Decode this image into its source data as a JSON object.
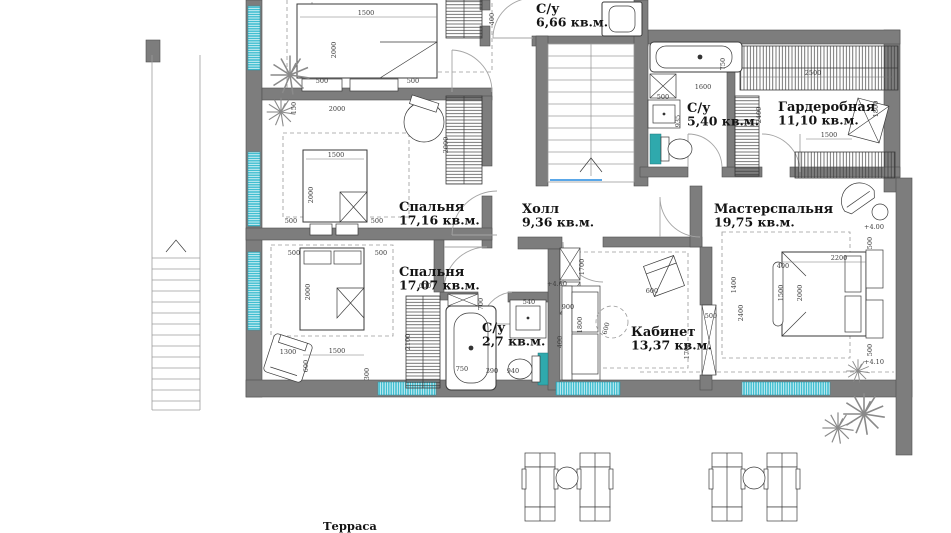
{
  "plan_title": "Floor plan (level +4.00)",
  "colors": {
    "wall": "#7d7d7d",
    "window": "#38bccf",
    "teal_accent": "#2fa9ad",
    "stair_blue": "#5aa7e8",
    "text": "#141414",
    "dimension_text": "#3d3d3d",
    "background": "#ffffff"
  },
  "rooms": [
    {
      "name": "С/у",
      "area": "6,66 кв.м.",
      "x": 536,
      "y": 5
    },
    {
      "name": "Спальня",
      "area": "17,16 кв.м.",
      "x": 399,
      "y": 203
    },
    {
      "name": "Холл",
      "area": "9,36 кв.м.",
      "x": 522,
      "y": 205
    },
    {
      "name": "Мастерспальня",
      "area": "19,75 кв.м.",
      "x": 714,
      "y": 205
    },
    {
      "name": "С/у",
      "area": "5,40 кв.м.",
      "x": 687,
      "y": 104
    },
    {
      "name": "Гардеробная",
      "area": "11,10 кв.м.",
      "x": 778,
      "y": 103
    },
    {
      "name": "Спальня",
      "area": "17,07 кв.м.",
      "x": 399,
      "y": 268
    },
    {
      "name": "С/у",
      "area": "2,7 кв.м.",
      "x": 482,
      "y": 324
    },
    {
      "name": "Кабинет",
      "area": "13,37 кв.м.",
      "x": 631,
      "y": 328
    }
  ],
  "terrace": {
    "label": "Терраса",
    "x": 345,
    "y": 530
  },
  "dimensions": [
    {
      "t": "1500",
      "x": 366,
      "y": 15
    },
    {
      "t": "2000",
      "x": 336,
      "y": 50,
      "r": -90
    },
    {
      "t": "500",
      "x": 322,
      "y": 83
    },
    {
      "t": "500",
      "x": 413,
      "y": 83
    },
    {
      "t": "2000",
      "x": 337,
      "y": 111
    },
    {
      "t": "150",
      "x": 296,
      "y": 108,
      "r": -90
    },
    {
      "t": "1500",
      "x": 336,
      "y": 157
    },
    {
      "t": "2000",
      "x": 313,
      "y": 195,
      "r": -90
    },
    {
      "t": "2000",
      "x": 448,
      "y": 145,
      "r": -90
    },
    {
      "t": "500",
      "x": 291,
      "y": 223
    },
    {
      "t": "500",
      "x": 377,
      "y": 223
    },
    {
      "t": "500",
      "x": 294,
      "y": 255
    },
    {
      "t": "500",
      "x": 381,
      "y": 255
    },
    {
      "t": "2000",
      "x": 310,
      "y": 292,
      "r": -90
    },
    {
      "t": "1500",
      "x": 337,
      "y": 353
    },
    {
      "t": "1300",
      "x": 288,
      "y": 354
    },
    {
      "t": "600",
      "x": 308,
      "y": 366,
      "r": -90
    },
    {
      "t": "300",
      "x": 369,
      "y": 374,
      "r": -90
    },
    {
      "t": "600",
      "x": 425,
      "y": 288
    },
    {
      "t": "2100",
      "x": 410,
      "y": 342,
      "r": -90
    },
    {
      "t": "700",
      "x": 483,
      "y": 304,
      "r": -90
    },
    {
      "t": "540",
      "x": 529,
      "y": 304
    },
    {
      "t": "750",
      "x": 462,
      "y": 371
    },
    {
      "t": "390",
      "x": 492,
      "y": 373
    },
    {
      "t": "940",
      "x": 513,
      "y": 373
    },
    {
      "t": "400",
      "x": 562,
      "y": 342,
      "r": -90
    },
    {
      "t": "1700",
      "x": 584,
      "y": 267,
      "r": -90
    },
    {
      "t": "+4.00",
      "x": 557,
      "y": 286
    },
    {
      "t": "400",
      "x": 494,
      "y": 19,
      "r": -90
    },
    {
      "t": "1600",
      "x": 703,
      "y": 89
    },
    {
      "t": "935",
      "x": 680,
      "y": 121,
      "r": -90
    },
    {
      "t": "500",
      "x": 663,
      "y": 99
    },
    {
      "t": "750",
      "x": 725,
      "y": 64,
      "r": -90
    },
    {
      "t": "2500",
      "x": 813,
      "y": 75
    },
    {
      "t": "2400",
      "x": 761,
      "y": 115,
      "r": -90
    },
    {
      "t": "1800",
      "x": 878,
      "y": 109,
      "r": -90
    },
    {
      "t": "1500",
      "x": 829,
      "y": 137
    },
    {
      "t": "2200",
      "x": 839,
      "y": 260
    },
    {
      "t": "2000",
      "x": 802,
      "y": 293,
      "r": -90
    },
    {
      "t": "1500",
      "x": 783,
      "y": 293,
      "r": -90
    },
    {
      "t": "400",
      "x": 783,
      "y": 268
    },
    {
      "t": "1400",
      "x": 736,
      "y": 285,
      "r": -90
    },
    {
      "t": "2400",
      "x": 743,
      "y": 313,
      "r": -90
    },
    {
      "t": "500",
      "x": 872,
      "y": 243,
      "r": -90
    },
    {
      "t": "500",
      "x": 872,
      "y": 350,
      "r": -90
    },
    {
      "t": "+4.00",
      "x": 874,
      "y": 229
    },
    {
      "t": "+4.10",
      "x": 874,
      "y": 364
    },
    {
      "t": "900",
      "x": 568,
      "y": 309
    },
    {
      "t": "1800",
      "x": 582,
      "y": 325,
      "r": -90
    },
    {
      "t": "600",
      "x": 608,
      "y": 329,
      "r": -75
    },
    {
      "t": "600",
      "x": 652,
      "y": 293
    },
    {
      "t": "1700",
      "x": 689,
      "y": 351,
      "r": -90
    },
    {
      "t": "500",
      "x": 711,
      "y": 318
    }
  ]
}
